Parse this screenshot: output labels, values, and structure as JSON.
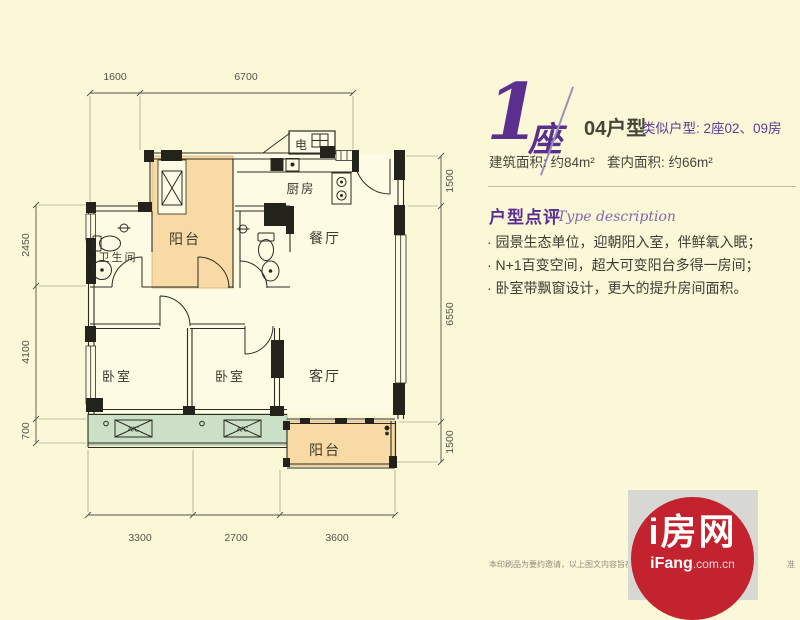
{
  "header": {
    "building_number": "1",
    "building_suffix": "座",
    "unit_type": "04户型",
    "similar_units": "类似户型: 2座02、09房",
    "built_area": "建筑面积: 约84m²",
    "inner_area": "套内面积: 约66m²"
  },
  "review": {
    "title": "户型点评",
    "subtitle": "Type description",
    "bullets": [
      "· 园景生态单位，迎朝阳入室，伴鲜氧入眠；",
      "· N+1百变空间，超大可变阳台多得一房间；",
      "· 卧室带飘窗设计，更大的提升房间面积。"
    ]
  },
  "plan": {
    "rooms": {
      "electric": "电",
      "kitchen": "厨房",
      "balcony_top": "阳台",
      "bathroom": "卫生间",
      "dining": "餐厅",
      "bedroom_left": "卧室",
      "bedroom_mid": "卧室",
      "living": "客厅",
      "balcony_bottom": "阳台",
      "ac_left": "A/C",
      "ac_mid": "A/C"
    },
    "dims": {
      "top": [
        "1600",
        "6700"
      ],
      "left": [
        "2450",
        "4100",
        "700"
      ],
      "right": [
        "1500",
        "6550",
        "1500"
      ],
      "bottom": [
        "3300",
        "2700",
        "3600"
      ]
    }
  },
  "footer": {
    "disclaimer_left": "本印刷品为要约邀请，以上图文内容旨在提供信息，仅",
    "disclaimer_right": "准",
    "logo_title": "i房网",
    "logo_brand": "iFang",
    "logo_domain": ".com.cn"
  },
  "colors": {
    "background": "#FBF8D8",
    "balcony": "#F8DAA4",
    "bay_window": "#CBE0C6",
    "brand_purple": "#5b2f8f",
    "logo_red": "#c2232e",
    "wall": "#2c2c24"
  }
}
